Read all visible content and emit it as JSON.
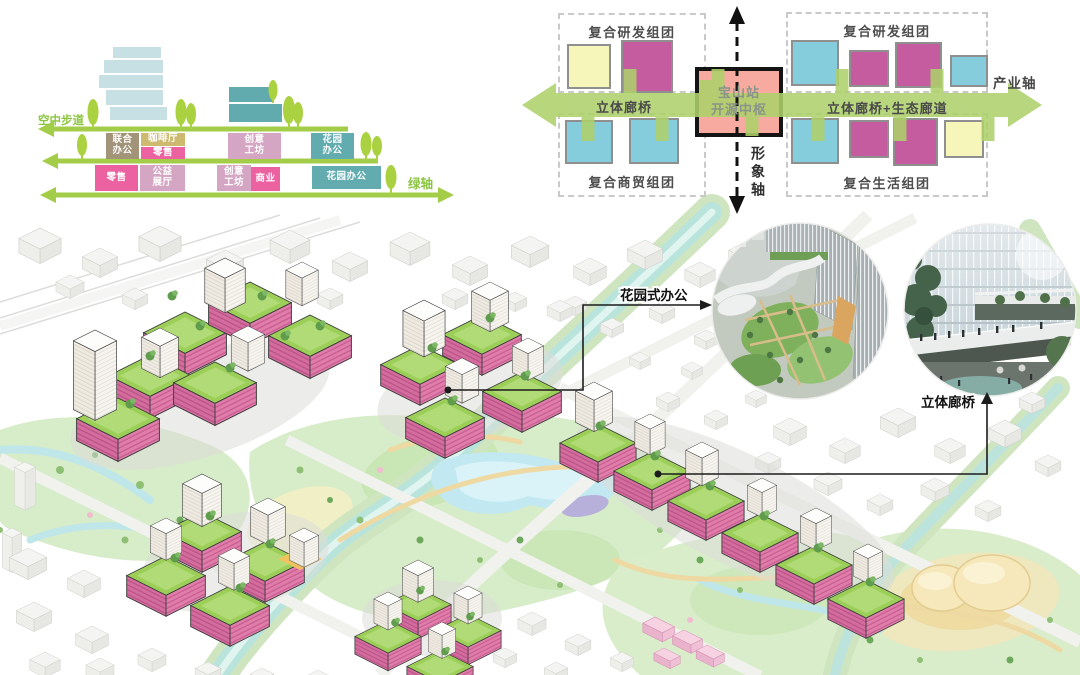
{
  "section_diagram": {
    "axis_labels": {
      "sky_walkway": "空中步道",
      "green_axis": "绿轴"
    },
    "upper_boxes": [
      {
        "label": "联合\n办公",
        "color": "#a29478"
      },
      {
        "label": "咖啡厅",
        "color": "#cdba70"
      },
      {
        "label": "零售",
        "color": "#ec619f"
      },
      {
        "label": "创意\n工坊",
        "color": "#d5a6c3"
      },
      {
        "label": "花园\n办公",
        "color": "#62acb0"
      }
    ],
    "ground_boxes": [
      {
        "label": "零售",
        "color": "#ec619f"
      },
      {
        "label": "公益\n展厅",
        "color": "#d5a6c3"
      },
      {
        "label": "创意\n工坊",
        "color": "#d5a6c3"
      },
      {
        "label": "商业",
        "color": "#ec619f"
      },
      {
        "label": "花园办公",
        "color": "#62acb0"
      }
    ]
  },
  "axis_diagram": {
    "cluster_labels": {
      "top_left": "复合研发组团",
      "bottom_left": "复合商贸组团",
      "top_right": "复合研发组团",
      "bottom_right": "复合生活组团"
    },
    "hub_label": "宝山站\n开源中枢",
    "corridor_left_label": "立体廊桥",
    "corridor_right_label": "立体廊桥+生态廊道",
    "industry_axis_label": "产业轴",
    "image_axis_label": "形象轴",
    "colors": {
      "hub_fill": "#f7aba0",
      "arrow_green": "#aed16b",
      "square_yellow": "#f6f6bb",
      "square_magenta": "#c45c9f",
      "square_blue": "#85ccdd"
    }
  },
  "masterplan": {
    "annotations": [
      {
        "label": "花园式办公"
      },
      {
        "label": "立体廊桥"
      }
    ],
    "colors": {
      "podium_pink": "#d46d9d",
      "roof_green": "#9ccf58",
      "water": "#bfe7ea",
      "park": "#d7ecc9"
    }
  }
}
